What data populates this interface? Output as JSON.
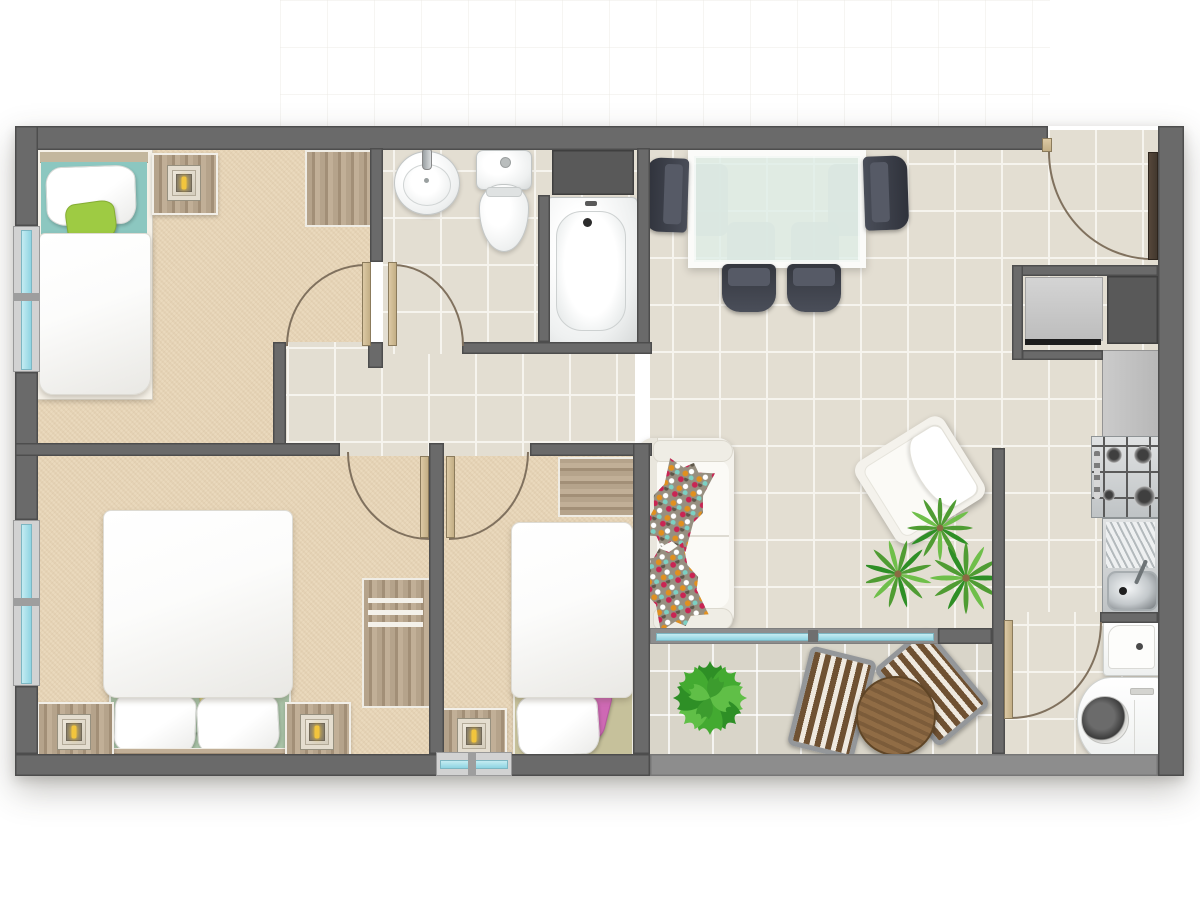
{
  "scene": {
    "kind": "apartment floor plan, top-down 2D render, no text labels",
    "rooms": [
      {
        "id": "bedroom-top-left",
        "floor": "carpet",
        "furniture": [
          "single-bed-teal-headboard",
          "white-pillow",
          "lime-pillow",
          "nightstand-with-lamp",
          "wood-closet"
        ],
        "openings": [
          "left-window",
          "swing-door-to-hallway"
        ]
      },
      {
        "id": "bathroom",
        "floor": "tile",
        "furniture": [
          "round-sink",
          "toilet",
          "bathtub",
          "dark-shelf-block"
        ],
        "openings": [
          "swing-door-to-hallway"
        ]
      },
      {
        "id": "hallway",
        "floor": "tile",
        "furniture": []
      },
      {
        "id": "living-dining",
        "floor": "tile",
        "furniture": [
          "glass-dining-table",
          "dark-dining-chair-left",
          "dark-dining-chair-right",
          "dark-dining-chair-bottom-1",
          "dark-dining-chair-bottom-2",
          "white-sofa",
          "mosaic-pillow-upper",
          "mosaic-pillow-lower",
          "white-armchair-rotated",
          "spiky-green-plant"
        ],
        "openings": [
          "entry-door-top-right",
          "sliding-glass-door-to-balcony"
        ]
      },
      {
        "id": "entry-storage",
        "floor": "tile",
        "furniture": [
          "storage-cabinet-light-panel",
          "dark-shaft-block"
        ]
      },
      {
        "id": "kitchen-strip",
        "floor": "tile",
        "furniture": [
          "counter",
          "gas-stove-4-burners",
          "steel-sink-with-drainboard"
        ],
        "openings": [
          "swing-door-to-laundry"
        ]
      },
      {
        "id": "laundry-nook",
        "floor": "tile",
        "furniture": [
          "shower-tray",
          "washing-machine"
        ]
      },
      {
        "id": "master-bedroom",
        "floor": "carpet",
        "furniture": [
          "double-bed-sage-base",
          "white-pillow-left",
          "white-pillow-right",
          "sage-pillow",
          "olive-pillow",
          "wood-headboard",
          "nightstand-with-lamp-left",
          "nightstand-with-lamp-right",
          "wood-dresser-3-drawers"
        ],
        "openings": [
          "left-window",
          "swing-door-to-hallway"
        ]
      },
      {
        "id": "bedroom-middle",
        "floor": "carpet",
        "furniture": [
          "single-bed-khaki-base",
          "white-pillow",
          "pink-pillow",
          "nightstand-with-lamp",
          "wood-closet"
        ],
        "openings": [
          "bottom-window",
          "swing-door-to-hallway"
        ]
      },
      {
        "id": "balcony",
        "floor": "tile-light",
        "furniture": [
          "monstera-plant",
          "round-wood-table",
          "slatted-chair-left",
          "slatted-chair-right"
        ]
      }
    ],
    "opening_counts": {
      "windows": 3,
      "swing_doors": 6,
      "sliding_doors": 1
    }
  },
  "palette": {
    "wall": "#6a6a6a",
    "wallEdge": "#4d4d4d",
    "wallLight": "#8d8d8d",
    "shelf": "#595959",
    "tile": "#e3ded2",
    "tileLine": "#f6f4ee",
    "balconyTile": "#d9d5c9",
    "carpet": "#ead9bd",
    "frame": "#d2d2d2",
    "glass": "#8fd4e2",
    "doorTan": "#dcc9a4",
    "doorEdge": "#8b7b5c",
    "arc": "#80715e",
    "entryDoor": "#43382e",
    "teal": "#8cc7c0",
    "lime": "#9ecb43",
    "sage": "#aac4a8",
    "olive": "#d6d083",
    "pink": "#ce69b4",
    "khaki": "#c6c19b",
    "cream": "#f4f2ec",
    "chairDark": "#3e414b",
    "chairFrame": "#94979a",
    "balconyWood": "#7c5c3a",
    "plantDark": "#2e8f26",
    "plantMid": "#4f9c33",
    "plantLight": "#6fbf4a",
    "bulb": "#f2c53d",
    "steel": "#cfd2d4"
  }
}
